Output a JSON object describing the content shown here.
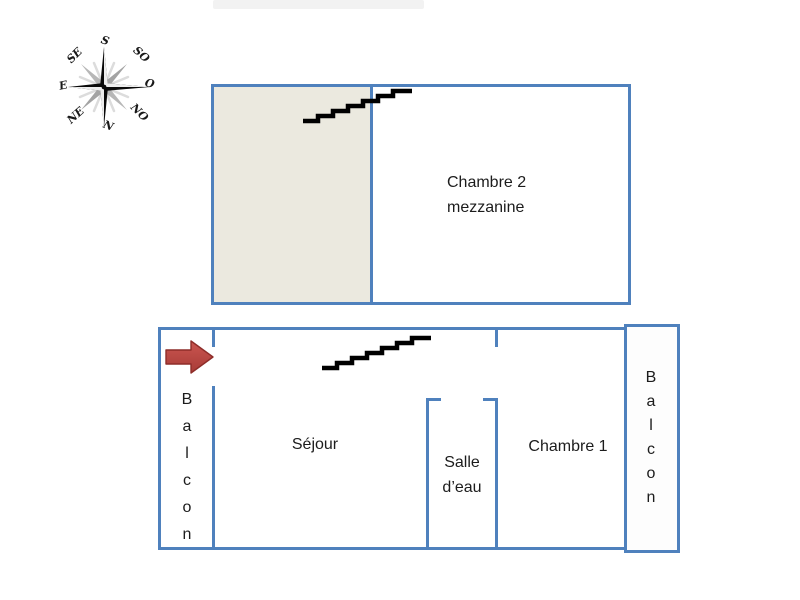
{
  "compass": {
    "points": [
      {
        "dir": "south",
        "label": "S"
      },
      {
        "dir": "south-west",
        "label": "SO"
      },
      {
        "dir": "west",
        "label": "O"
      },
      {
        "dir": "north-west",
        "label": "NO"
      },
      {
        "dir": "north",
        "label": "N"
      },
      {
        "dir": "north-east",
        "label": "NE"
      },
      {
        "dir": "east",
        "label": "E"
      },
      {
        "dir": "south-east",
        "label": "SE"
      }
    ]
  },
  "upper_plan": {
    "room": {
      "line1": "Chambre 2",
      "line2": "mezzanine"
    }
  },
  "lower_plan": {
    "sejour": "Séjour",
    "salle_deau": {
      "line1": "Salle",
      "line2": "d’eau"
    },
    "chambre1": "Chambre 1",
    "balcon_left": "Balcon",
    "balcon_right": "Balcon"
  },
  "colors": {
    "wall_blue": "#4f81bd",
    "mezzanine_fill": "#ebe9df",
    "entrance_arrow_red": "#c0504d",
    "stairs_black": "#000000"
  }
}
